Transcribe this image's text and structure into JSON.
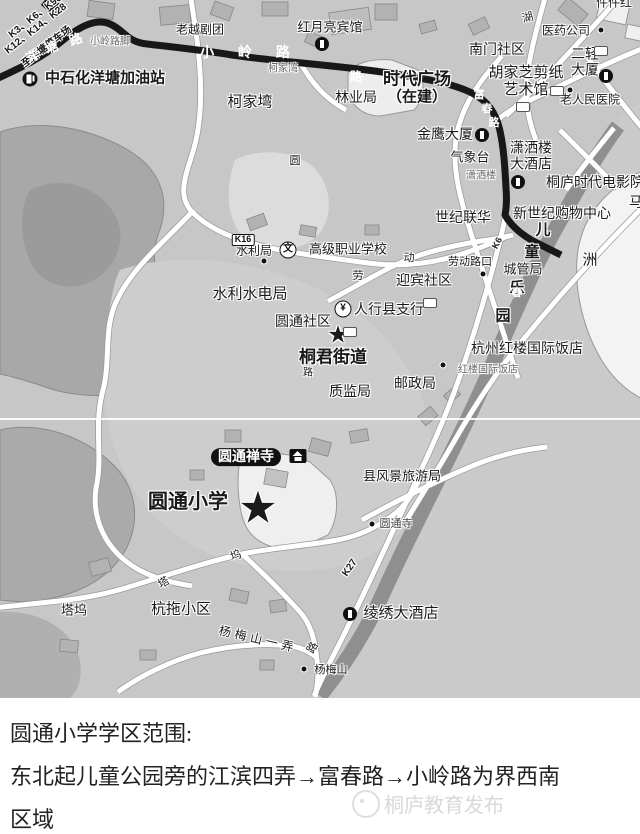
{
  "map": {
    "base_color": "#c7c7c7",
    "route_color": "#181818",
    "riverbank_color": "#8f8f8f",
    "labels": [
      {
        "n": "bus-routes-line-1",
        "t": "K3、K6、K9、K",
        "x": 40,
        "y": 13,
        "s": 10,
        "b": 1,
        "r": -38
      },
      {
        "n": "bus-routes-line-2",
        "t": "K12、K14、K28",
        "x": 36,
        "y": 29,
        "s": 10,
        "b": 1,
        "r": -38
      },
      {
        "n": "to-yangtang-parking",
        "t": "至洋塘停车场",
        "x": 47,
        "y": 47,
        "s": 10,
        "b": 1,
        "r": -38
      },
      {
        "n": "road-char-yang",
        "t": "洋",
        "x": 33,
        "y": 57,
        "s": 13,
        "b": 1,
        "c": "#ffffff",
        "h": 0,
        "r": -28
      },
      {
        "n": "road-char-tang",
        "t": "塘",
        "x": 52,
        "y": 48,
        "s": 13,
        "b": 1,
        "c": "#ffffff",
        "h": 0,
        "r": -25
      },
      {
        "n": "road-char-lu-yangtang",
        "t": "路",
        "x": 76,
        "y": 40,
        "s": 13,
        "b": 1,
        "c": "#ffffff",
        "h": 0,
        "r": -20
      },
      {
        "n": "xiaoling-lujiao",
        "t": "小岭路脚",
        "x": 110,
        "y": 42,
        "s": 10,
        "c": "#666666"
      },
      {
        "n": "lao-yue-ju-tuan",
        "t": "老越剧团",
        "x": 200,
        "y": 30,
        "s": 12
      },
      {
        "n": "road-xiaoling",
        "t": "小 岭 路",
        "x": 250,
        "y": 53,
        "s": 14,
        "b": 1,
        "c": "#ffffff",
        "h": 0,
        "ls": 10
      },
      {
        "n": "hongyueliang-hotel",
        "t": "红月亮宾馆",
        "x": 330,
        "y": 28,
        "s": 13
      },
      {
        "n": "sinopec-yangtang-gas",
        "t": "中石化洋塘加油站",
        "x": 105,
        "y": 79,
        "s": 15,
        "b": 1
      },
      {
        "n": "kejiawan-stop",
        "t": "柯家湾",
        "x": 283,
        "y": 69,
        "s": 10,
        "c": "#666666"
      },
      {
        "n": "kejiawan-area",
        "t": "柯家塆",
        "x": 250,
        "y": 103,
        "s": 15
      },
      {
        "n": "road-char-lu-top",
        "t": "路",
        "x": 356,
        "y": 77,
        "s": 12,
        "b": 1,
        "c": "#ffffff",
        "h": 0
      },
      {
        "n": "shidai-plaza",
        "t": "时代广场",
        "x": 417,
        "y": 79,
        "s": 17,
        "b": 1
      },
      {
        "n": "under-construction",
        "t": "（在建）",
        "x": 417,
        "y": 98,
        "s": 15,
        "b": 1
      },
      {
        "n": "forestry-bureau",
        "t": "林业局",
        "x": 356,
        "y": 98,
        "s": 14
      },
      {
        "n": "nanmen-community",
        "t": "南门社区",
        "x": 497,
        "y": 50,
        "s": 14
      },
      {
        "n": "pharma-company",
        "t": "医药公司",
        "x": 566,
        "y": 31,
        "s": 12
      },
      {
        "n": "erqing-tower",
        "t": "二轻\n大厦",
        "x": 585,
        "y": 62,
        "s": 14
      },
      {
        "n": "hujiazhi-papercut-museum",
        "t": "胡家芝剪纸\n艺术馆",
        "x": 526,
        "y": 82,
        "s": 15
      },
      {
        "n": "old-peoples-hospital",
        "t": "老人民医院",
        "x": 590,
        "y": 100,
        "s": 12
      },
      {
        "n": "jinying-tower",
        "t": "金鹰大厦",
        "x": 445,
        "y": 135,
        "s": 14
      },
      {
        "n": "weather-station",
        "t": "气象台",
        "x": 470,
        "y": 158,
        "s": 13
      },
      {
        "n": "xiaosalou-stop",
        "t": "潇洒楼",
        "x": 481,
        "y": 176,
        "s": 10,
        "c": "#666666"
      },
      {
        "n": "xiaosalou-hotel",
        "t": "潇洒楼\n大酒店",
        "x": 531,
        "y": 156,
        "s": 14
      },
      {
        "n": "tonglu-shidai-cinema",
        "t": "桐庐时代电影院",
        "x": 546,
        "y": 183,
        "s": 14,
        "anchor": "left"
      },
      {
        "n": "shiji-lianhua",
        "t": "世纪联华",
        "x": 463,
        "y": 218,
        "s": 14
      },
      {
        "n": "xinshiji-mall",
        "t": "新世纪购物中心",
        "x": 562,
        "y": 214,
        "s": 14
      },
      {
        "n": "kids-park-char-er",
        "t": "儿",
        "x": 543,
        "y": 231,
        "s": 15,
        "b": 1
      },
      {
        "n": "kids-park-char-tong",
        "t": "童",
        "x": 532,
        "y": 253,
        "s": 15,
        "b": 1
      },
      {
        "n": "kids-park-char-le",
        "t": "乐",
        "x": 517,
        "y": 289,
        "s": 15,
        "b": 1
      },
      {
        "n": "kids-park-char-yuan",
        "t": "园",
        "x": 503,
        "y": 317,
        "s": 15,
        "b": 1
      },
      {
        "n": "chengguanju",
        "t": "城管局",
        "x": 523,
        "y": 270,
        "s": 13
      },
      {
        "n": "islet-zhou",
        "t": "洲",
        "x": 590,
        "y": 261,
        "s": 15
      },
      {
        "n": "partial-char-ma",
        "t": "马",
        "x": 636,
        "y": 203,
        "s": 14
      },
      {
        "n": "partial-label-top-right",
        "t": "件件红",
        "x": 614,
        "y": 3,
        "s": 12
      },
      {
        "n": "hangzhou-honglou-hotel",
        "t": "杭州红楼国际饭店",
        "x": 527,
        "y": 349,
        "s": 14
      },
      {
        "n": "honglou-hotel-stop",
        "t": "红楼国际饭店",
        "x": 488,
        "y": 370,
        "s": 10,
        "c": "#666666"
      },
      {
        "n": "shuiliju",
        "t": "水利局",
        "x": 254,
        "y": 251,
        "s": 12
      },
      {
        "n": "vocational-school",
        "t": "高级职业学校",
        "x": 348,
        "y": 250,
        "s": 13
      },
      {
        "n": "shuili-shuidianju",
        "t": "水利水电局",
        "x": 250,
        "y": 295,
        "s": 15
      },
      {
        "n": "yingbin-community",
        "t": "迎宾社区",
        "x": 424,
        "y": 281,
        "s": 14
      },
      {
        "n": "laodong-lukou-stop",
        "t": "劳动路口",
        "x": 470,
        "y": 262,
        "s": 11
      },
      {
        "n": "road-char-lao",
        "t": "劳",
        "x": 358,
        "y": 276,
        "s": 11
      },
      {
        "n": "road-char-dong",
        "t": "动",
        "x": 409,
        "y": 258,
        "s": 11
      },
      {
        "n": "pboc-county-branch",
        "t": "人行县支行",
        "x": 389,
        "y": 310,
        "s": 14
      },
      {
        "n": "yuantong-community",
        "t": "圆通社区",
        "x": 303,
        "y": 322,
        "s": 14
      },
      {
        "n": "star-tongjun",
        "t": "★",
        "x": 338,
        "y": 336,
        "s": 24
      },
      {
        "n": "tongjun-jiedao",
        "t": "桐君街道",
        "x": 333,
        "y": 357,
        "s": 17,
        "b": 1
      },
      {
        "n": "road-char-lu-mid",
        "t": "路",
        "x": 308,
        "y": 373,
        "s": 10
      },
      {
        "n": "zhijianju",
        "t": "质监局",
        "x": 350,
        "y": 392,
        "s": 14
      },
      {
        "n": "youzhengju",
        "t": "邮政局",
        "x": 415,
        "y": 384,
        "s": 14
      },
      {
        "n": "road-char-fu",
        "t": "富",
        "x": 479,
        "y": 95,
        "s": 11,
        "b": 1,
        "c": "#ffffff",
        "h": 0
      },
      {
        "n": "road-char-chun",
        "t": "春",
        "x": 487,
        "y": 109,
        "s": 11,
        "b": 1,
        "c": "#ffffff",
        "h": 0
      },
      {
        "n": "road-char-lu-fuchun",
        "t": "路",
        "x": 494,
        "y": 123,
        "s": 11,
        "b": 1,
        "c": "#ffffff",
        "h": 0
      },
      {
        "n": "road-char-chun-south",
        "t": "春",
        "x": 517,
        "y": 293,
        "s": 11,
        "b": 1,
        "c": "#ffffff",
        "h": 0
      },
      {
        "n": "road-char-hu",
        "t": "湖",
        "x": 528,
        "y": 18,
        "s": 11,
        "r": -15
      },
      {
        "n": "yuantong-chansi",
        "t": "圆通禅寺",
        "x": 246,
        "y": 457,
        "s": 14,
        "b": 1,
        "c": "#ffffff",
        "bg": 1
      },
      {
        "n": "yuantong-primary-school",
        "t": "圆通小学",
        "x": 188,
        "y": 502,
        "s": 20,
        "b": 1
      },
      {
        "n": "star-yuantong-school",
        "t": "★",
        "x": 258,
        "y": 508,
        "s": 44
      },
      {
        "n": "county-tourism-bureau",
        "t": "县风景旅游局",
        "x": 402,
        "y": 477,
        "s": 13
      },
      {
        "n": "yuantongsi-stop",
        "t": "圆通寺",
        "x": 396,
        "y": 524,
        "s": 11,
        "c": "#444444"
      },
      {
        "n": "route-k27",
        "t": "K27",
        "x": 350,
        "y": 568,
        "s": 10,
        "b": 1,
        "r": -55
      },
      {
        "n": "route-k6",
        "t": "K6",
        "x": 497,
        "y": 243,
        "s": 9,
        "b": 1,
        "r": -62
      },
      {
        "n": "lingxiu-hotel",
        "t": "绫绣大酒店",
        "x": 401,
        "y": 614,
        "s": 15
      },
      {
        "n": "tawu-area",
        "t": "塔坞",
        "x": 74,
        "y": 611,
        "s": 13
      },
      {
        "n": "road-char-ta",
        "t": "塔",
        "x": 164,
        "y": 583,
        "s": 11,
        "r": -30
      },
      {
        "n": "road-char-wu",
        "t": "坞",
        "x": 236,
        "y": 556,
        "s": 11,
        "r": -20
      },
      {
        "n": "hangtuo-xiaoqu",
        "t": "杭拖小区",
        "x": 181,
        "y": 610,
        "s": 15
      },
      {
        "n": "road-yangmeishan-yinong",
        "t": "杨梅山一弄",
        "x": 258,
        "y": 640,
        "s": 12,
        "r": 13,
        "ls": 4
      },
      {
        "n": "road-char-lu-south",
        "t": "路",
        "x": 313,
        "y": 648,
        "s": 11,
        "r": -60
      },
      {
        "n": "yangmeishan-stop",
        "t": "杨梅山",
        "x": 331,
        "y": 670,
        "s": 11
      },
      {
        "n": "road-char-yuan",
        "t": "圆",
        "x": 295,
        "y": 161,
        "s": 11
      }
    ],
    "badges": [
      {
        "n": "badge-k16",
        "t": "K16",
        "x": 243,
        "y": 240
      },
      {
        "n": "badge-route-1",
        "x": 523,
        "y": 107
      },
      {
        "n": "badge-route-2",
        "x": 557,
        "y": 91
      },
      {
        "n": "badge-route-3",
        "x": 601,
        "y": 51
      },
      {
        "n": "badge-route-4",
        "x": 430,
        "y": 303
      },
      {
        "n": "badge-route-5",
        "x": 350,
        "y": 332
      }
    ],
    "icons": [
      {
        "n": "hotel-icon-hongyueliang",
        "type": "hotel",
        "x": 322,
        "y": 44
      },
      {
        "n": "hotel-icon-erqing",
        "type": "hotel",
        "x": 606,
        "y": 76
      },
      {
        "n": "hotel-icon-jinying",
        "type": "hotel",
        "x": 482,
        "y": 135
      },
      {
        "n": "hotel-icon-xiaosalou",
        "type": "hotel",
        "x": 518,
        "y": 182
      },
      {
        "n": "hotel-icon-lingxiu",
        "type": "hotel",
        "x": 350,
        "y": 614
      },
      {
        "n": "gas-station-icon",
        "type": "gas",
        "x": 30,
        "y": 79
      },
      {
        "n": "bank-icon",
        "type": "bank",
        "x": 343,
        "y": 309,
        "g": "¥"
      },
      {
        "n": "school-icon",
        "type": "school",
        "x": 288,
        "y": 250,
        "g": "文"
      },
      {
        "n": "temple-icon",
        "type": "temple",
        "x": 298,
        "y": 456
      }
    ],
    "stops": [
      {
        "x": 601,
        "y": 30
      },
      {
        "x": 570,
        "y": 90
      },
      {
        "x": 264,
        "y": 261
      },
      {
        "x": 483,
        "y": 274
      },
      {
        "x": 443,
        "y": 365
      },
      {
        "x": 372,
        "y": 524
      },
      {
        "x": 304,
        "y": 669
      }
    ]
  },
  "caption": {
    "lines": [
      "圆通小学学区范围:",
      "东北起儿童公园旁的江滨四弄→富春路→小岭路为界西南",
      "区域"
    ]
  },
  "watermark": {
    "text": "桐庐教育发布"
  }
}
